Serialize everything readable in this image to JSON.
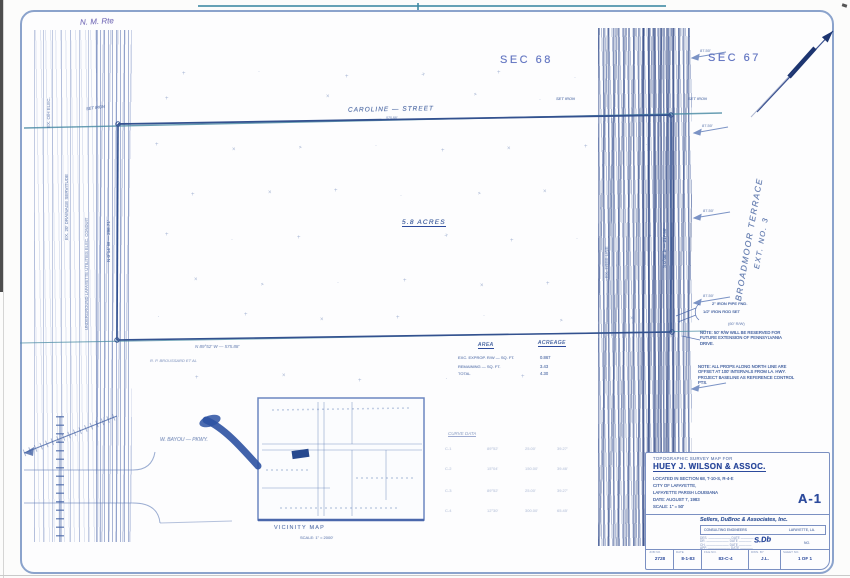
{
  "annotations": {
    "handwritten_note": "N. M. Rte"
  },
  "sections": {
    "left": "SEC 68",
    "right": "SEC 67"
  },
  "streets": {
    "top_label": "CAROLINE  —  STREET",
    "top_sub": "575.88'",
    "right_vertical_line1": "BROADMOOR TERRACE",
    "right_vertical_line2": "EXT. NO. 3",
    "bottom_left_label": "W. BAYOU — PKWY."
  },
  "survey": {
    "site_area_label": "5.8 ACRES",
    "corner_nw": "SET IRON",
    "corner_ne_left": "SET IRON",
    "corner_ne_right": "SET IRON",
    "bottom_bearing": "N 89°52' W — 575.88'",
    "left_bearing_vertical": "N 0°14' W — 296.71'",
    "right_bearing_vertical": "S 0°08' E — 217.56'",
    "left_band_label1": "EX. 20' DRAINAGE SERVITUDE",
    "left_band_label2": "UNDERGROUND LAFAYETTE UTILITIES ELEC. CONDUIT",
    "left_band_label3": "EX. O/H ELEC.",
    "right_band_label": "EX. TREE LINE",
    "owner_label": "R. P. BROUSSARD ET AL",
    "margin_tick_label": "87.50'"
  },
  "notes": {
    "pipe_found": "2\" IRON PIPE FND.",
    "rod_set": "1/2\" IRON ROD SET",
    "rw_tag": "(60' R/W)",
    "note1": "NOTE: 50' R/W WILL BE RESERVED FOR FUTURE EXTENSION OF PENNSYLVANIA DRIVE.",
    "note2": "NOTE: ALL PROPS ALONG NORTH LINE ARE OFFSET AT 100' INTERVALS FROM LA. HWY. PROJECT BASELINE AS REFERENCE CONTROL PTS."
  },
  "area_table": {
    "headers": [
      "AREA",
      "ACREAGE"
    ],
    "rows": [
      [
        "EXC. EXPROP. R/W — SQ. FT.",
        "0.867"
      ],
      [
        "REMAINING — SQ. FT.",
        "3.43"
      ],
      [
        "TOTAL",
        "4.30"
      ]
    ]
  },
  "curve_table": {
    "title": "CURVE DATA",
    "rows": [
      [
        "C-1",
        "89°52'",
        "25.00'",
        "39.27'"
      ],
      [
        "C-2",
        "15°04'",
        "150.00'",
        "39.46'"
      ],
      [
        "C-3",
        "89°52'",
        "25.00'",
        "39.27'"
      ],
      [
        "C-4",
        "12°30'",
        "300.00'",
        "65.45'"
      ]
    ]
  },
  "vicinity": {
    "title": "VICINITY MAP",
    "scale": "SCALE: 1\" = 2000'"
  },
  "title_block": {
    "heading_small": "TOPOGRAPHIC SURVEY MAP FOR",
    "client": "HUEY J. WILSON & ASSOC.",
    "located": "LOCATED IN SECTION 68, T-10-S, R-4-E",
    "city": "CITY OF LAFAYETTE,",
    "parish": "LAFAYETTE PARISH LOUISIANA",
    "date": "DATE: AUGUST 7, 1983",
    "scale": "SCALE: 1\" = 50'",
    "sheet_no": "A-1",
    "firm": "Sellers, DuBroc & Associates, Inc.",
    "firm_sub_left": "CONSULTING ENGINEERS",
    "firm_sub_right": "LAFAYETTE, LA.",
    "approval_rows": [
      "DES.",
      "DR.",
      "CH.",
      "APP."
    ],
    "approval_date_label": "DATE",
    "approval_scribble": "S.Db",
    "approval_no": "NO.",
    "fields": [
      {
        "label": "JOB NO.",
        "value": "2728"
      },
      {
        "label": "DATE",
        "value": "8-1-83"
      },
      {
        "label": "FILE NO.",
        "value": "83-C-4"
      },
      {
        "label": "DWN. BY",
        "value": "J.L."
      },
      {
        "label": "SHEET NO.",
        "value": "1 OF 1"
      }
    ]
  }
}
